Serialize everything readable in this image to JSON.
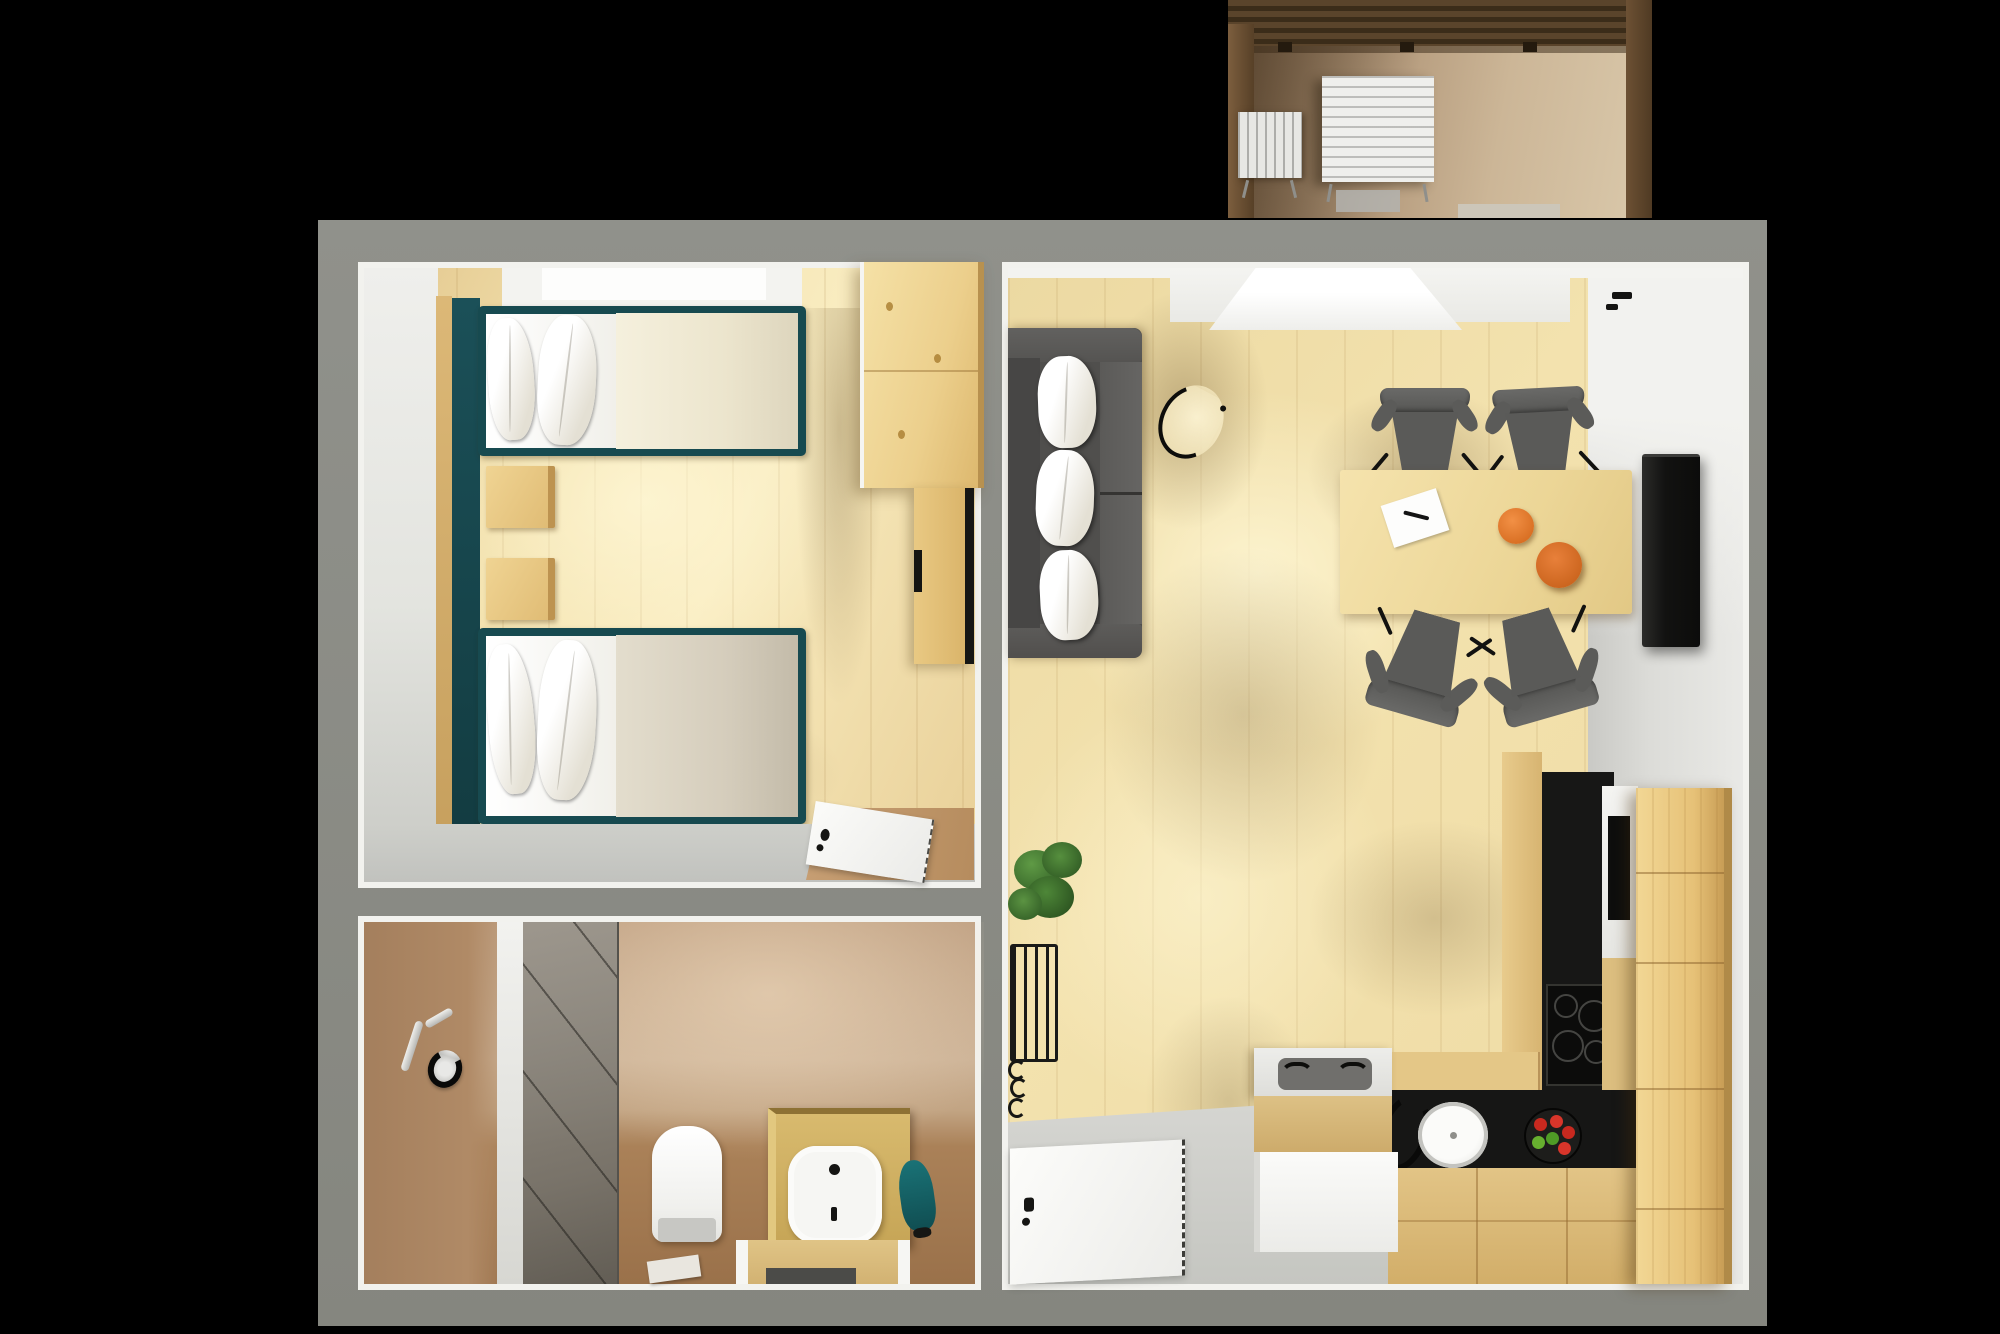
{
  "meta": {
    "title": "3D apartment floor plan render",
    "view": "top-down 3D rendering",
    "background_color": "#000000"
  },
  "palette": {
    "outer_wall": "#8b8c86",
    "room_trim_white": "#f2f2ee",
    "wood_floor": "#f0dfa9",
    "gray_floor": "#c8c9c5",
    "teal_accent": "#17464c",
    "pine_furniture": "#e6c987",
    "sofa_gray": "#525250",
    "cushion_cream": "#e8dfc9",
    "kitchen_counter_black": "#161615",
    "bathroom_wall_tan": "#c0a183",
    "bathroom_floor_brown": "#9a714a",
    "balcony_wood_brown": "#5a442b",
    "orange_fruit": "#d06418"
  },
  "rooms": {
    "balcony": {
      "name": "balcony",
      "items": [
        "slatted table",
        "slatted chair",
        "door mat",
        "door threshold"
      ]
    },
    "bedroom": {
      "name": "bedroom",
      "items": [
        "window",
        "teal headboard panel",
        "single bed top",
        "single bed bottom",
        "nightstand upper",
        "nightstand lower",
        "wardrobe",
        "dresser desk",
        "open door with mat"
      ]
    },
    "bathroom": {
      "name": "bathroom",
      "items": [
        "towel hook",
        "shower glass panel",
        "toilet",
        "washbasin cabinet",
        "wooden bench",
        "floor mat",
        "teal robe"
      ]
    },
    "living_room": {
      "name": "living room with kitchen",
      "items": [
        "balcony door",
        "sofa with three cushions",
        "round side table",
        "dining table",
        "four dining chairs",
        "paper with pen",
        "two oranges",
        "wall tv panel",
        "potted plant on stand",
        "entry door",
        "kitchen island with tray",
        "pine counter",
        "black countertop",
        "cooktop with four burners",
        "built-in oven",
        "round sink",
        "faucet ring",
        "fruit bowl with apples",
        "tall pine cabinet"
      ]
    }
  },
  "counts": {
    "beds": 2,
    "dining_chairs": 4,
    "sofa_cushions": 3,
    "cooktop_burners": 4,
    "nightstands": 2
  }
}
